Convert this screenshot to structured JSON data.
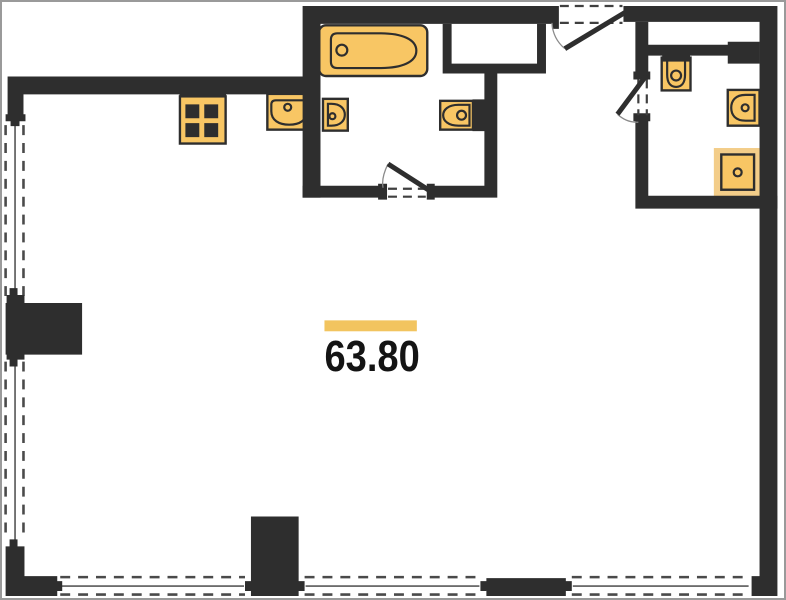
{
  "plan": {
    "area_label": "63.80",
    "colors": {
      "wall": "#2e2e2e",
      "fixture": "#f8c664",
      "fixture_light": "#f3cd89",
      "accent_bar": "#f2c45f",
      "window_line": "#4a4a4a",
      "door_arc": "#8a8a8a",
      "background": "#ffffff",
      "frame": "#9a9a9a",
      "text": "#141414"
    },
    "fixtures": [
      {
        "name": "stove"
      },
      {
        "name": "kitchen-sink"
      },
      {
        "name": "bathtub"
      },
      {
        "name": "hand-basin"
      },
      {
        "name": "toilet-main-bath"
      },
      {
        "name": "toilet-second-bath"
      },
      {
        "name": "wall-basin"
      },
      {
        "name": "shower-tray"
      }
    ],
    "doors": [
      {
        "name": "entry-door"
      },
      {
        "name": "main-bathroom-door"
      },
      {
        "name": "second-bathroom-door"
      }
    ],
    "windows": [
      {
        "name": "left-window"
      },
      {
        "name": "bottom-window-1"
      },
      {
        "name": "bottom-window-2"
      },
      {
        "name": "bottom-window-3"
      }
    ]
  }
}
